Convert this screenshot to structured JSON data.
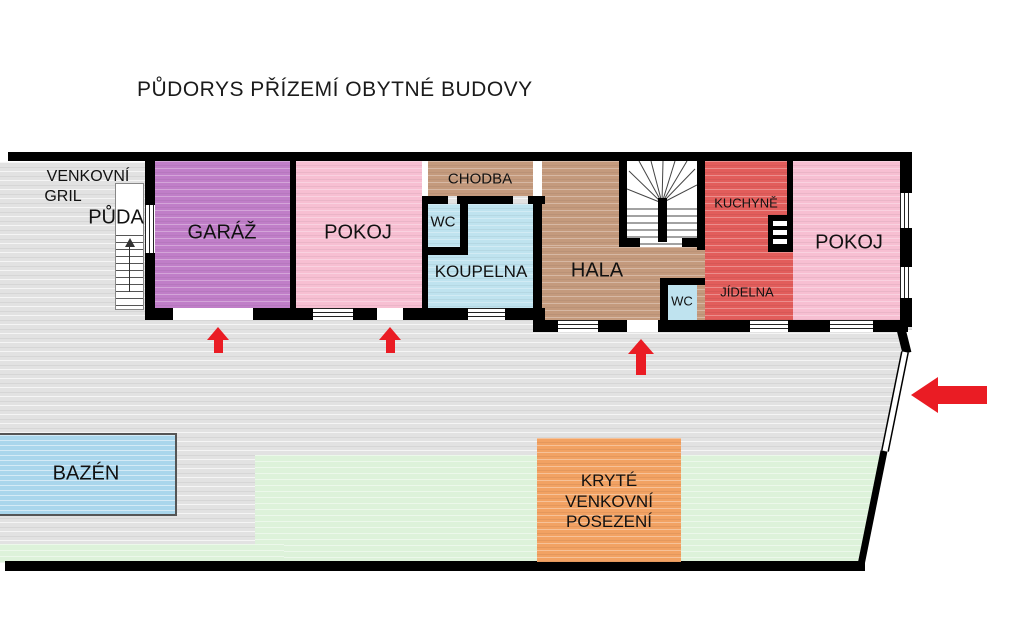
{
  "title": "PŮDORYS PŘÍZEMÍ OBYTNÉ BUDOVY",
  "outdoor": {
    "grill_line1": "VENKOVNÍ",
    "grill_line2": "GRIL",
    "attic_stairs": "PŮDA",
    "pool": "BAZÉN",
    "seating_line1": "KRYTÉ",
    "seating_line2": "VENKOVNÍ",
    "seating_line3": "POSEZENÍ"
  },
  "rooms": {
    "garage": "GARÁŽ",
    "room_left": "POKOJ",
    "hallway": "CHODBA",
    "wc_small": "WC",
    "bathroom": "KOUPELNA",
    "hall": "HALA",
    "kitchen": "KUCHYNĚ",
    "dining": "JÍDELNA",
    "wc_hall": "WC",
    "room_right": "POKOJ"
  },
  "colors": {
    "wall": "#000000",
    "terrace": "#e2e2e2",
    "lawn": "#ddf2da",
    "pool": "#a9d6ec",
    "garage": "#c07ec8",
    "bedroom_pink": "#f7bfd2",
    "hall_tan": "#c49a7d",
    "bath_blue": "#bfe3ef",
    "kitchen_red": "#e25d5b",
    "seating_orange": "#f2a263",
    "arrow_red": "#ea1c24"
  },
  "icons": {
    "entrance_arrow_up": "red arrow pointing up at entrance doors",
    "entrance_arrow_left": "red arrow pointing left at driveway gate",
    "stairs_up_arrow": "direction-up arrow on attic staircase"
  }
}
